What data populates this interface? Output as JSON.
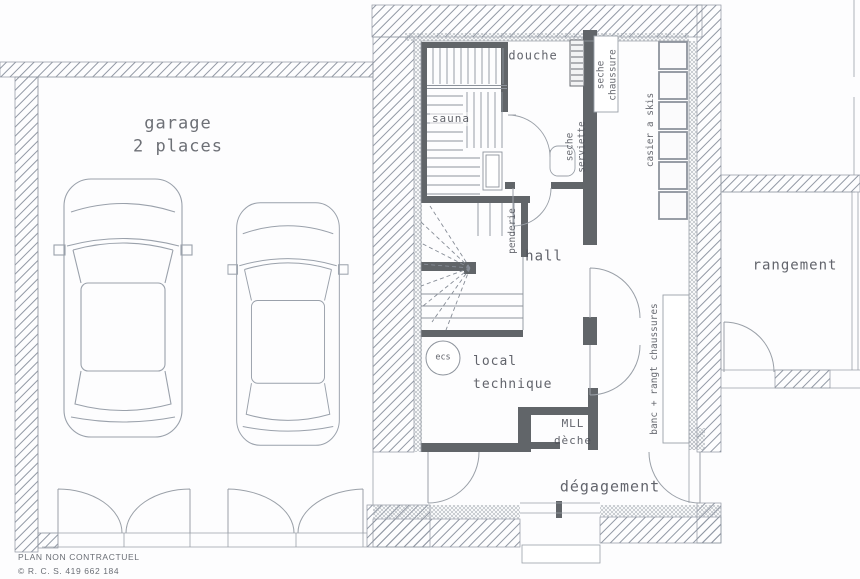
{
  "plan": {
    "title_area": {
      "garage_line1": "garage",
      "garage_line2": "2 places"
    },
    "rooms": {
      "douche": "douche",
      "sauna": "sauna",
      "hall": "hall",
      "local_technique_line1": "local",
      "local_technique_line2": "technique",
      "degagement": "dégagement",
      "rangement": "rangement"
    },
    "fixtures": {
      "seche_serviette_line1": "seche",
      "seche_serviette_line2": "serviette",
      "seche_chaussure_line1": "seche",
      "seche_chaussure_line2": "chaussure",
      "casier_skis": "casier a skis",
      "penderie": "penderie",
      "ecs": "ecs",
      "mll": "MLL",
      "seche_linge": "dèche",
      "banc": "banc + rangt chaussures"
    }
  },
  "footer": {
    "disclaimer": "PLAN NON CONTRACTUEL",
    "rcs": "© R. C. S. 419 662 184"
  },
  "colors": {
    "wall_dark": "#616569",
    "hatch_line": "#9198a4",
    "sketch_line": "#9aa0a8",
    "text": "#4d5058"
  }
}
